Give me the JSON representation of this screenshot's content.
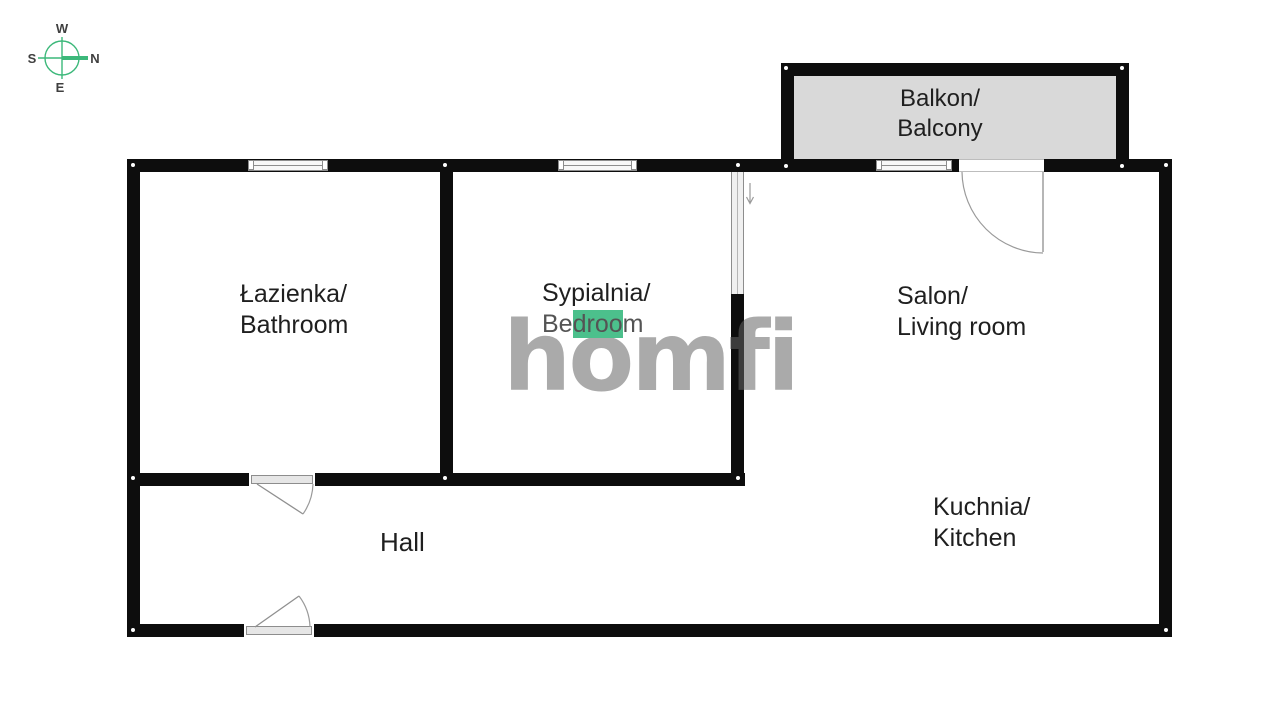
{
  "compass": {
    "top": "W",
    "left": "S",
    "right": "N",
    "bottom": "E"
  },
  "watermark": {
    "text": "homfi"
  },
  "rooms": {
    "balcony": {
      "name_pl": "Balkon/",
      "name_en": "Balcony"
    },
    "bathroom": {
      "name_pl": "Łazienka/",
      "name_en": "Bathroom"
    },
    "bedroom": {
      "name_pl": "Sypialnia/",
      "name_en_pre": "Be",
      "name_en_highlight": "droo",
      "name_en_post": "m"
    },
    "living_room": {
      "name_pl": "Salon/",
      "name_en": "Living room"
    },
    "kitchen": {
      "name_pl": "Kuchnia/",
      "name_en": "Kitchen"
    },
    "hall": {
      "name": "Hall"
    }
  },
  "colors": {
    "wall": "#0d0d0d",
    "balcony_fill": "#d9d9d9",
    "compass_green": "#3cb87a",
    "highlight_green": "#4cc08c",
    "watermark_gray": "#ababab"
  }
}
